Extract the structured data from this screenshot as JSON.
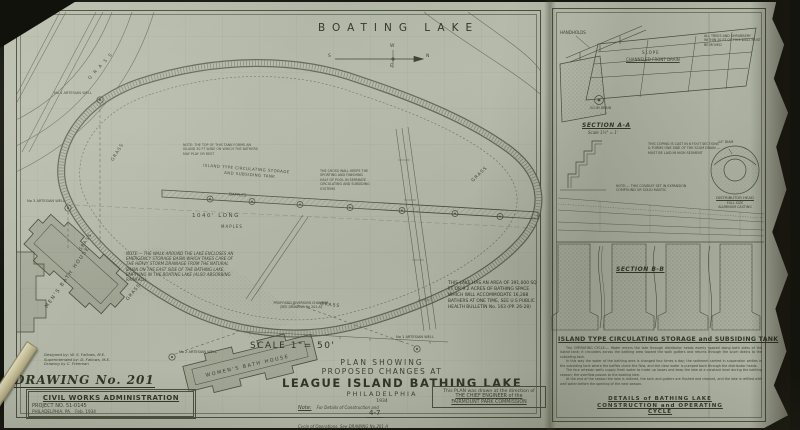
{
  "plan": {
    "boating_lake": "BOATING LAKE",
    "compass": {
      "n": "N",
      "s": "S",
      "e": "E",
      "w": "W"
    },
    "grass": [
      "G R A S S",
      "GRASS",
      "GRASS",
      "GRASS",
      "GRASS",
      "GRASS"
    ],
    "island_label_1": "ISLAND TYPE CIRCULATING STORAGE",
    "island_label_2": "AND SUBSIDING TANK",
    "baffles": "BAFFLES",
    "length_label": "1040' LONG",
    "maples": "MAPLES",
    "island_top_note": "NOTE: THE TOP OF THIS TANK FORMS AN ISLAND 30 FT WIDE ON WHICH THE BATHERS MAY PLAY OR REST",
    "cross_wall_note": "THE CROSS WALL KEEPS THE SPORTING AND FINISHING HALF OF POOL IN SEPARATE CIRCULATING AND SUBSIDING SYSTEMS",
    "walk_note": "NOTE:— THE WALK AROUND THE LAKE ENCLOSES AN EMERGENCY STORAGE BASIN WHICH TAKES CARE OF THE HEAVY STORM DRAINAGE FROM THE NATURAL BASIN ON THE EAST SIDE OF THE BATHING LAKE, EMPTYING IN THE BOATING LAKE (ALSO ABSORBING RAINFALL)",
    "area_note": "THIS LAKE HAS AN AREA OF 391,000 SQ FT OR 9.2 ACRES OF BATHING SPACE WHICH WILL ACCOMMODATE 16,288 BATHERS AT ONE TIME, SEE U.S PUBLIC HEALTH BULLETIN No. 163 (PP. 26-28)",
    "diversion_note": "PROPOSED DIVERSION CHAMBER (SEE DRAWING No 201-A)",
    "scale_label": "SCALE 1\"= 50'",
    "wells": {
      "w1": "No 1 ARTESIAN WELL",
      "w2": "No 2 ARTESIAN WELL",
      "w3": "No 3 ARTESIAN WELL",
      "w4": "No 4 ARTESIAN WELL"
    },
    "mens_bath_house": "MEN'S BATH HOUSE",
    "womens_bath_house": "WOMEN'S BATH HOUSE"
  },
  "title_block": {
    "line1": "PLAN SHOWING",
    "line2": "PROPOSED CHANGES AT",
    "line3": "LEAGUE ISLAND BATHING LAKE",
    "line4": "PHILADELPHIA",
    "line5": "1934",
    "note_label": "Note:",
    "note_text": "For Details of Construction and Cycle of Operations, See DRAWING No.201-A",
    "statement_1": "This PLAN was drawn at the direction of",
    "statement_2": "THE CHIEF ENGINEER of the",
    "statement_3": "FAIRMOUNT PARK COMMISSION",
    "sheet_number": "4-7"
  },
  "credits": {
    "designed": "Designed by: W. S. Fallows, M.E.",
    "supervised": "Superintended by: D. Fallows, M.E.",
    "drawn": "Drawing by C. Freeman",
    "drawing_no": "DRAWING No. 201",
    "agency": "CIVIL WORKS ADMINISTRATION",
    "project": "PROJECT NO. 51-0145",
    "location": "PHILADELPHIA, PA.",
    "date": "Feb. 1934"
  },
  "details_panel": {
    "handholds": "HANDHOLDS",
    "trees_note": "ALL TREES AND SHRUBBERY WITHIN 20 FT OF THIS WALL MUST BE MOVED",
    "slope": "SLOPE",
    "front_drain": "CHANNELED FRONT DRAIN",
    "scum_drain": "SCUM DRAIN",
    "section_a": "SECTION A-A",
    "section_a_scale": "Scale 1½\" = 1'",
    "coping_note": "THIS COPING IS CAST IN 6 FOOT SECTIONS & FORMS ONE SIDE OF THE SCUM DRAIN — MUST BE LAID IN HIGH SEGMENT",
    "conduit_note": "NOTE:— THIS CONDUIT SET IN EXPANSION COMPOUND OR SOLID MASTIC",
    "diam": "14\" DIAM",
    "distributor_1": "DISTRIBUTOR HEAD",
    "distributor_2": "FULL SIZE",
    "distributor_3": "ALUMINUM CASTING",
    "section_b": "SECTION B-B",
    "island_heading": "ISLAND TYPE CIRCULATING STORAGE and SUBSIDING TANK",
    "paragraphs": [
      "The OPERATING CYCLE:— Water enters the lake through distributor heads evenly spaced along both sides of the island tank; it circulates across the bathing area toward the walk gutters and returns through the scum drains to the subsiding tank.",
      "In this way the water of the bathing area is changed four times a day; the sediment carried in suspension settles in the subsiding tank where the baffles check the flow, and the clear water is pumped back through the distributor heads.",
      "The four artesian wells supply fresh water to make up losses and keep the lake at a constant level during the bathing season; the overflow passes to the boating lake.",
      "At the end of the season the lake is drained, the tank and gutters are flushed and cleaned, and the lake is refilled with well water before the opening of the next season."
    ],
    "footer_1": "DETAILS of BATHING LAKE",
    "footer_2": "CONSTRUCTION and OPERATING",
    "footer_3": "CYCLE"
  }
}
